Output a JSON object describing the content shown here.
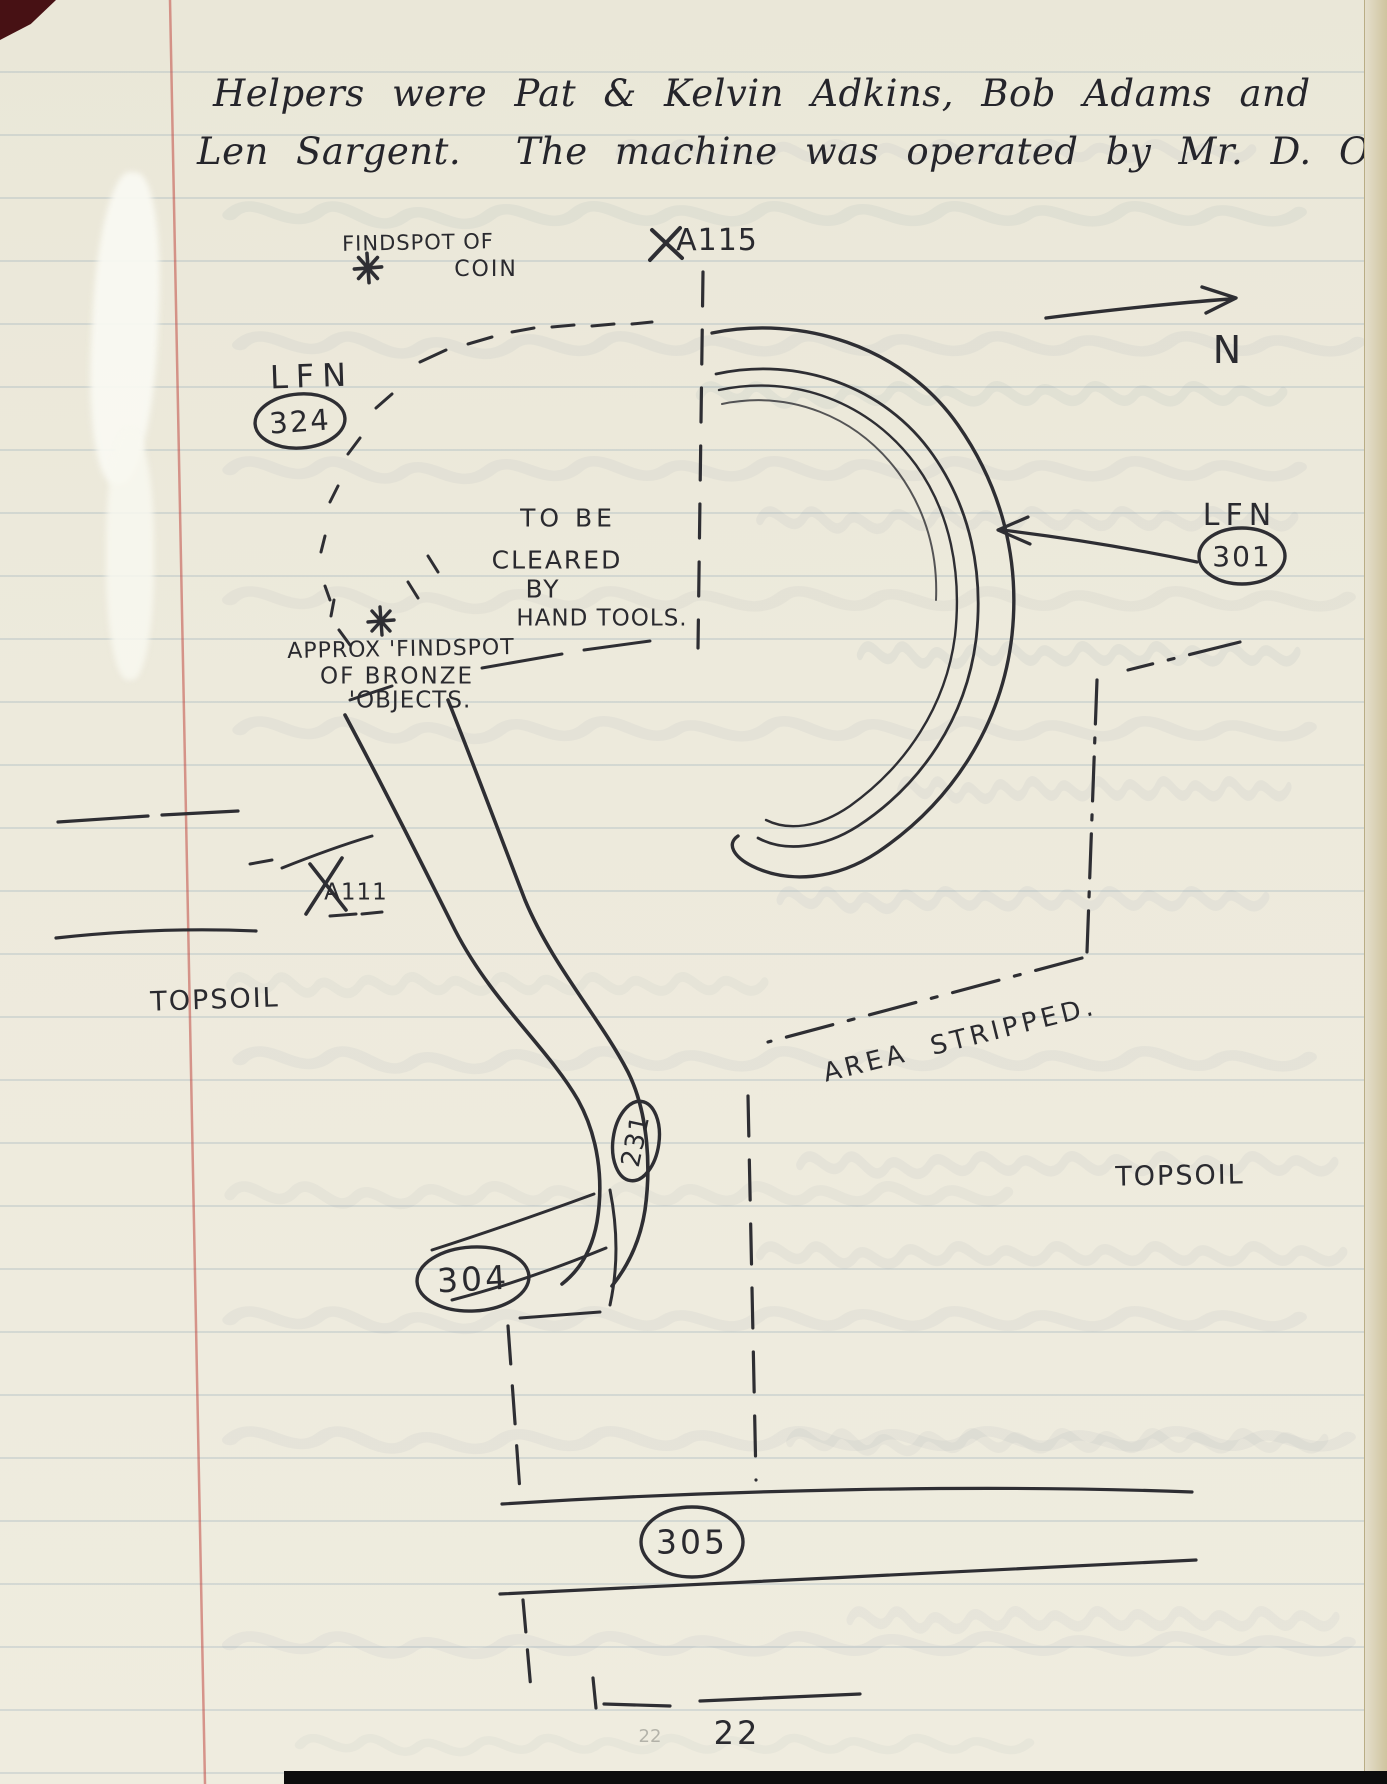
{
  "page": {
    "header_line1": "Helpers were Pat & Kelvin Adkins, Bob Adams and",
    "header_line2": "Len Sargent.  The machine was operated by Mr. D. Orris.",
    "page_number": "22",
    "pencil_page_number": "22"
  },
  "labels": {
    "findspot_coin_1": "FINDSPOT OF",
    "findspot_coin_2": "COIN",
    "a115": "A115",
    "north": "N",
    "lfn_324_prefix": "LFN",
    "lfn_324_number": "324",
    "lfn_301_prefix": "LFN",
    "lfn_301_number": "301",
    "cleared_1": "TO BE",
    "cleared_2": "CLEARED",
    "cleared_3": "BY",
    "cleared_4": "HAND TOOLS.",
    "bronze_1": "APPROX 'FINDSPOT",
    "bronze_2": "OF BRONZE",
    "bronze_3": "'OBJECTS.",
    "a111": "A111",
    "topsoil_left": "TOPSOIL",
    "area_stripped": "AREA  STRIPPED.",
    "topsoil_right": "TOPSOIL",
    "feature_231": "231",
    "feature_304": "304",
    "feature_305": "305"
  },
  "colors": {
    "ink": "#2e2e33",
    "paper": "#ebe8da",
    "margin_line": "#c14b44",
    "rule_line": "#7896ac"
  }
}
